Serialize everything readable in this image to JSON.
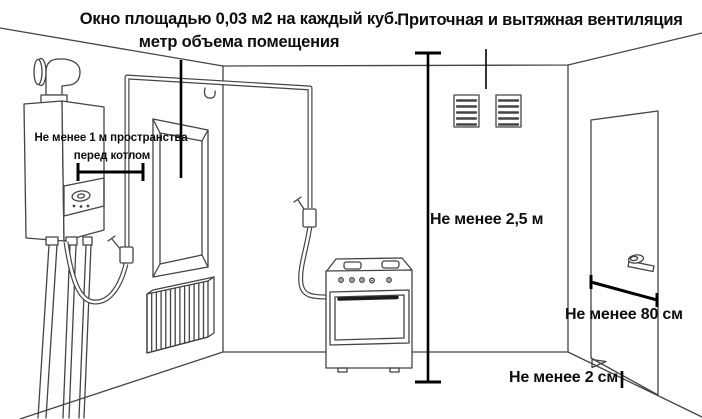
{
  "canvas": {
    "width": 702,
    "height": 419,
    "background": "#ffffff"
  },
  "colors": {
    "line": "#444444",
    "annotation": "#000000",
    "text": "#0d0d0d"
  },
  "annotations": {
    "window_note_line1": "Окно площадью 0,03 м2 на каждый куб.",
    "window_note_line2": "метр объема помещения",
    "ventilation_note": "Приточная и вытяжная вентиляция",
    "boiler_clearance_line1": "Не менее 1 м пространства",
    "boiler_clearance_line2": "перед котлом",
    "ceiling_height": "Не менее 2,5 м",
    "door_width": "Не менее 80 см",
    "door_gap": "Не менее 2 см"
  }
}
